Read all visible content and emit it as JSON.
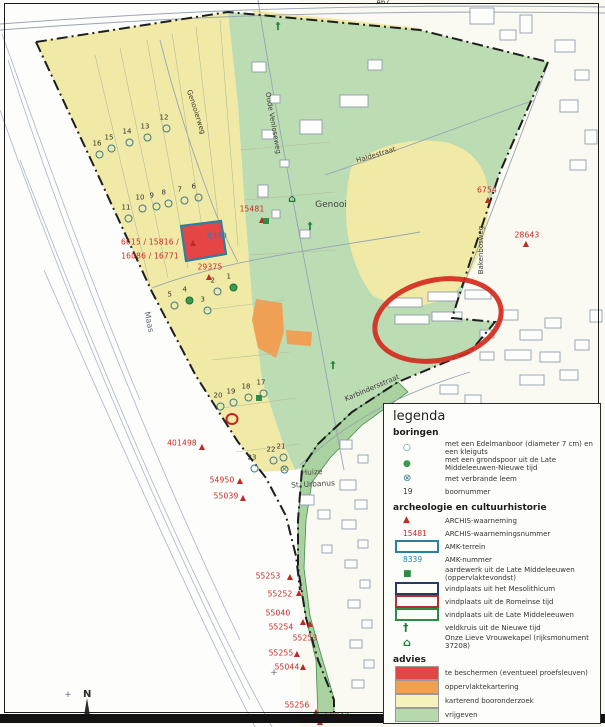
{
  "legend": {
    "title": "legenda",
    "rows": [
      {
        "cls": "heading",
        "label": "boringen"
      },
      {
        "cls": "s-circle-open",
        "icontext": "○",
        "label": "met een Edelmanboor (diameter 7 cm) en een kleiguts"
      },
      {
        "cls": "s-circle-green",
        "icontext": "●",
        "label": "met een grondspoor uit de Late Middeleeuwen-Nieuwe tijd"
      },
      {
        "cls": "s-circle-crossed",
        "icontext": "⊗",
        "label": "met verbrande leem"
      },
      {
        "cls": "s-num",
        "icontext": "19",
        "label": "boornummer"
      },
      {
        "cls": "heading",
        "label": "archeologie en cultuurhistorie"
      },
      {
        "cls": "s-triangle",
        "icontext": "▲",
        "label": "ARCHIS-waarneming"
      },
      {
        "cls": "s-num-red",
        "icontext": "15481",
        "label": "ARCHIS-waarnemingsnummer"
      },
      {
        "cls": "s-rect r-teal",
        "icontext": "",
        "label": "AMK-terrein"
      },
      {
        "cls": "s-num-blue",
        "icontext": "8339",
        "label": "AMK-nummer"
      },
      {
        "cls": "s-gsquare",
        "icontext": "■",
        "label": "aardewerk uit de Late Middeleeuwen (oppervlaktevondst)"
      },
      {
        "cls": "s-rect r-navy",
        "icontext": "",
        "label": "vindplaats uit het Mesolithicum"
      },
      {
        "cls": "s-rect r-red",
        "icontext": "",
        "label": "vindplaats uit de Romeinse tijd"
      },
      {
        "cls": "s-rect r-green",
        "icontext": "",
        "label": "vindplaats uit de Late Middeleeuwen"
      },
      {
        "cls": "s-cross",
        "icontext": "†",
        "label": "veldkruis uit de Nieuwe tijd"
      },
      {
        "cls": "s-chapel",
        "icontext": "⌂",
        "label": "Onze Lieve Vrouwekapel (rijksmonument 37208)"
      },
      {
        "cls": "heading",
        "label": "advies"
      },
      {
        "cls": "s-fill f-red",
        "icontext": "",
        "label": "te beschermen (eventueel proefsleuven)"
      },
      {
        "cls": "s-fill f-orange",
        "icontext": "",
        "label": "oppervlaktekartering"
      },
      {
        "cls": "s-fill f-yellow",
        "icontext": "",
        "label": "karterend booronderzoek"
      },
      {
        "cls": "s-fill f-green",
        "icontext": "",
        "label": "vrijgeven"
      }
    ]
  },
  "map": {
    "north_label": "N",
    "street_labels": [
      {
        "text": "A67",
        "x": 383,
        "y": 2,
        "rot": -2
      },
      {
        "text": "Genooierweg",
        "x": 196,
        "y": 112,
        "rot": 72
      },
      {
        "text": "Oude Venloseweg",
        "x": 273,
        "y": 123,
        "rot": 80
      },
      {
        "text": "Haldestraat",
        "x": 376,
        "y": 155,
        "rot": -17
      },
      {
        "text": "Genooi",
        "x": 331,
        "y": 205,
        "rot": 0,
        "cls": "big"
      },
      {
        "text": "Bakenbosweg",
        "x": 481,
        "y": 250,
        "rot": -90
      },
      {
        "text": "Karbindersstraat",
        "x": 372,
        "y": 388,
        "rot": -23
      },
      {
        "text": "Maas",
        "x": 149,
        "y": 322,
        "rot": 78,
        "cls": "water"
      },
      {
        "text": "Huize",
        "x": 312,
        "y": 472,
        "rot": -3,
        "cls": "place"
      },
      {
        "text": "St. Urbanus",
        "x": 313,
        "y": 484,
        "rot": -3,
        "cls": "place"
      }
    ],
    "archis_labels": [
      {
        "text": "6754",
        "x": 487,
        "y": 190
      },
      {
        "text": "28643",
        "x": 527,
        "y": 235
      },
      {
        "text": "15481",
        "x": 252,
        "y": 209
      },
      {
        "text": "29375",
        "x": 210,
        "y": 267
      },
      {
        "text": "6615 / 15816 /",
        "x": 150,
        "y": 242
      },
      {
        "text": "16086 / 16771",
        "x": 150,
        "y": 256
      },
      {
        "text": "8339",
        "x": 217,
        "y": 236,
        "cls": "amk"
      },
      {
        "text": "401498",
        "x": 182,
        "y": 443
      },
      {
        "text": "54950",
        "x": 222,
        "y": 480
      },
      {
        "text": "55039",
        "x": 226,
        "y": 496
      },
      {
        "text": "55253",
        "x": 268,
        "y": 576
      },
      {
        "text": "55252",
        "x": 280,
        "y": 594
      },
      {
        "text": "55040",
        "x": 278,
        "y": 613
      },
      {
        "text": "55254",
        "x": 281,
        "y": 627
      },
      {
        "text": "55253",
        "x": 305,
        "y": 638
      },
      {
        "text": "55255",
        "x": 281,
        "y": 653
      },
      {
        "text": "55044",
        "x": 287,
        "y": 667
      },
      {
        "text": "55256",
        "x": 297,
        "y": 705
      },
      {
        "text": "55043",
        "x": 337,
        "y": 716
      }
    ],
    "triangles": [
      {
        "x": 488,
        "y": 200
      },
      {
        "x": 526,
        "y": 244
      },
      {
        "x": 262,
        "y": 220
      },
      {
        "x": 209,
        "y": 277
      },
      {
        "x": 193,
        "y": 243
      },
      {
        "x": 202,
        "y": 447
      },
      {
        "x": 240,
        "y": 481
      },
      {
        "x": 243,
        "y": 498
      },
      {
        "x": 290,
        "y": 577
      },
      {
        "x": 299,
        "y": 593
      },
      {
        "x": 303,
        "y": 622
      },
      {
        "x": 310,
        "y": 624
      },
      {
        "x": 297,
        "y": 654
      },
      {
        "x": 303,
        "y": 667
      },
      {
        "x": 316,
        "y": 712
      },
      {
        "x": 320,
        "y": 722
      }
    ],
    "boreholes": [
      {
        "n": "1",
        "x": 233,
        "y": 287,
        "cls": "filled"
      },
      {
        "n": "2",
        "x": 217,
        "y": 291
      },
      {
        "n": "3",
        "x": 207,
        "y": 310
      },
      {
        "n": "4",
        "x": 189,
        "y": 300,
        "cls": "filled"
      },
      {
        "n": "5",
        "x": 174,
        "y": 305
      },
      {
        "n": "6",
        "x": 198,
        "y": 197
      },
      {
        "n": "7",
        "x": 184,
        "y": 200
      },
      {
        "n": "8",
        "x": 168,
        "y": 203
      },
      {
        "n": "9",
        "x": 156,
        "y": 206
      },
      {
        "n": "10",
        "x": 142,
        "y": 208
      },
      {
        "n": "11",
        "x": 128,
        "y": 218
      },
      {
        "n": "12",
        "x": 166,
        "y": 128
      },
      {
        "n": "13",
        "x": 147,
        "y": 137
      },
      {
        "n": "14",
        "x": 129,
        "y": 142
      },
      {
        "n": "15",
        "x": 111,
        "y": 148
      },
      {
        "n": "16",
        "x": 99,
        "y": 154
      },
      {
        "n": "17",
        "x": 263,
        "y": 393
      },
      {
        "n": "18",
        "x": 248,
        "y": 397
      },
      {
        "n": "19",
        "x": 233,
        "y": 402
      },
      {
        "n": "20",
        "x": 220,
        "y": 406
      },
      {
        "n": "21",
        "x": 283,
        "y": 457
      },
      {
        "n": "22",
        "x": 273,
        "y": 460
      },
      {
        "n": "23",
        "x": 254,
        "y": 468
      },
      {
        "n": "",
        "x": 284,
        "y": 469,
        "cls": "crossed"
      }
    ],
    "symbols": [
      {
        "cls": "cross",
        "x": 278,
        "y": 24
      },
      {
        "cls": "chapel",
        "x": 292,
        "y": 197
      },
      {
        "cls": "cross",
        "x": 310,
        "y": 224
      },
      {
        "cls": "cross",
        "x": 333,
        "y": 363
      },
      {
        "cls": "gsquare",
        "x": 266,
        "y": 221
      },
      {
        "cls": "gsquare",
        "x": 259,
        "y": 398
      },
      {
        "cls": "red-ring",
        "x": 232,
        "y": 419
      },
      {
        "cls": "plus",
        "x": 68,
        "y": 692
      },
      {
        "cls": "plus",
        "x": 274,
        "y": 670
      }
    ],
    "colors": {
      "advies_te_beschermen": "#e64545",
      "advies_oppervlaktekartering": "#f0a055",
      "advies_karterend_booronderzoek": "#f5f2bc",
      "advies_vrijgeven": "#b5d9aa",
      "archis_text": "#c62828",
      "amk_border": "#2b7fa0",
      "annotation_ellipse": "#d42a1e"
    }
  }
}
